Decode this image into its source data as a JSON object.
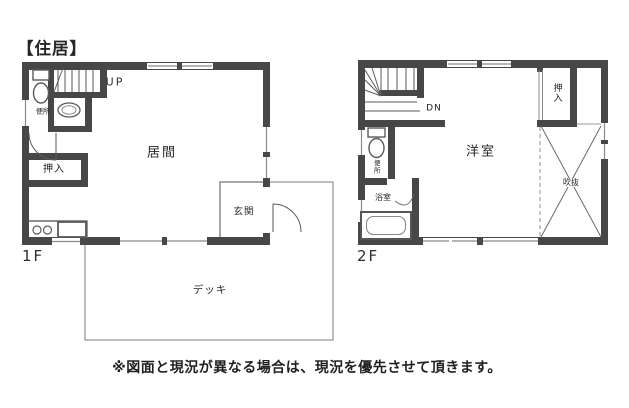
{
  "title": "【住居】",
  "note": "※図面と現況が異なる場合は、現況を優先させて頂きます。",
  "floor1": {
    "label": "1F",
    "stair_direction": "UP",
    "rooms": {
      "living": "居間",
      "closet": "押入",
      "toilet": "便所",
      "entrance": "玄関"
    },
    "exterior": {
      "deck": "デッキ"
    }
  },
  "floor2": {
    "label": "2F",
    "stair_direction": "DN",
    "rooms": {
      "western_room": "洋室",
      "closet": "押入",
      "toilet": "便所",
      "bath": "浴室",
      "void": "吹抜"
    }
  },
  "colors": {
    "wall": "#474747",
    "thin_line": "#8a8a8a",
    "fixture_line": "#5a5a5a",
    "text": "#262626",
    "background": "#ffffff"
  }
}
